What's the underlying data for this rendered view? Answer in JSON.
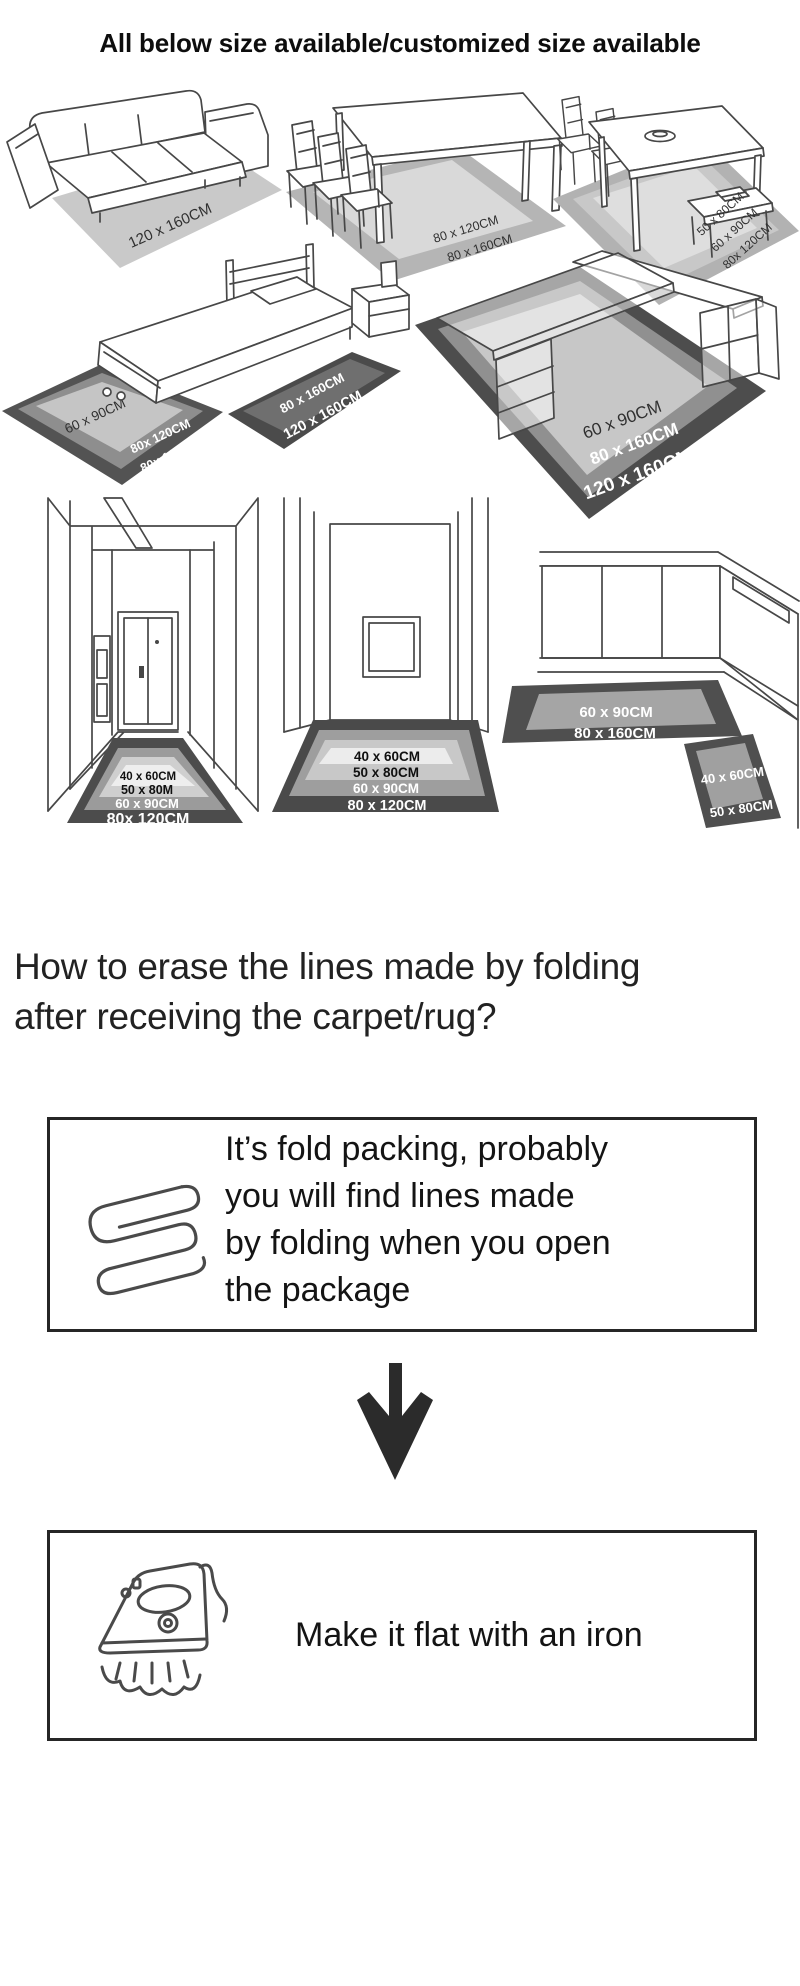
{
  "title": "All below size available/customized size available",
  "scenes": {
    "living_room": {
      "sizes": [
        "120 x 160CM"
      ]
    },
    "dining_room_a": {
      "sizes": [
        "80 x 120CM",
        "80 x 160CM"
      ]
    },
    "dining_room_b": {
      "sizes": [
        "50 x 80CM",
        "60 x 90CM",
        "80x 120CM"
      ]
    },
    "bedroom": {
      "side_rug_sizes": [
        "60 x 90CM",
        "80x 120CM",
        "80x 160CM"
      ],
      "foot_rug_sizes": [
        "80 x 160CM",
        "120 x 160CM"
      ]
    },
    "study": {
      "sizes": [
        "60 x 90CM",
        "80 x 160CM",
        "120 x 160CM"
      ]
    },
    "hallway_door": {
      "sizes": [
        "40 x 60CM",
        "50 x 80M",
        "60 x 90CM",
        "80x 120CM"
      ]
    },
    "hallway_plain": {
      "sizes": [
        "40 x 60CM",
        "50 x 80CM",
        "60 x 90CM",
        "80 x 120CM"
      ]
    },
    "kitchen": {
      "runner_sizes": [
        "60 x 90CM",
        "80 x 160CM"
      ],
      "mat_sizes": [
        "40 x 60CM",
        "50 x 80CM"
      ]
    }
  },
  "faq": {
    "line1": "How to erase the lines made by folding",
    "line2": "after receiving the carpet/rug?"
  },
  "steps": {
    "fold": {
      "icon": "folded-carpet",
      "lines": [
        "It’s fold packing, probably",
        "you will find lines made",
        "by folding when you open",
        "the package"
      ]
    },
    "iron": {
      "icon": "iron",
      "text": "Make it flat with an iron"
    }
  },
  "colors": {
    "rug_dark": "#4d4d4d",
    "rug_mid": "#8f8f8f",
    "rug_light": "#c7c7c7",
    "rug_lightest": "#ededed",
    "line_art": "#474747"
  }
}
